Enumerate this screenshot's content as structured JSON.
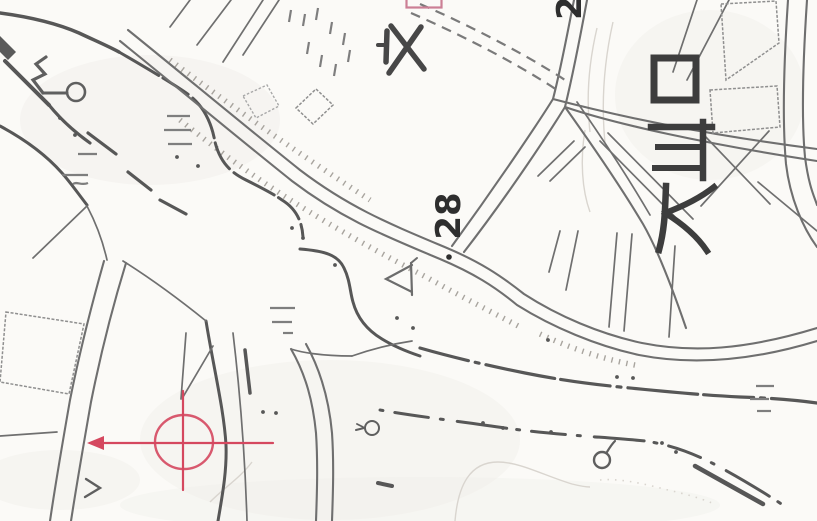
{
  "title": "Scanned topographic map with red target marker",
  "map": {
    "labels": {
      "spot_elevation": "28",
      "partial_number": "2",
      "place_name": "大山口"
    },
    "symbols": [
      "school-symbol",
      "well-spring-symbol",
      "conifer-symbol",
      "orchard-symbol",
      "orchard-symbol-small",
      "rice-paddy-marks",
      "chevron-mark",
      "spot-elevation-dot",
      "embankment-hatching"
    ],
    "colors": {
      "paper": "#fbfaf7",
      "map_line": "#6f6f6f",
      "bold_line": "#575757",
      "block_line": "#8f8f8f",
      "hatch": "#a8a49e",
      "contour": "#d9d5cf",
      "label_ink": "#2e2e2e",
      "kanji_ink": "#3d3d3d",
      "marker_red": "#d5485f",
      "rect_pink": "#cc7f95"
    },
    "marker": {
      "shape": "crosshair-circle-with-left-arrow",
      "center_x": "184",
      "center_y": "442",
      "radius_x": "29",
      "radius_y": "27",
      "secondary_red_rectangle": "partial rectangle clipped at top edge"
    }
  }
}
